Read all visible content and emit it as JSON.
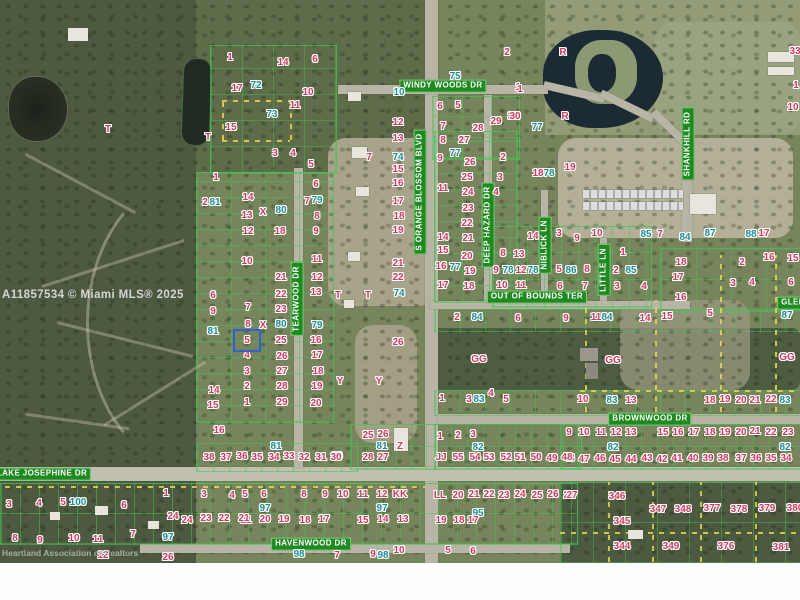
{
  "map": {
    "mls_watermark": "A11857534 © Miami MLS® 2025",
    "attribution_watermark": "Heartland Association of Realtors",
    "highlighted_lot": {
      "label": "5"
    },
    "colors": {
      "lot_number": "#cf3a5e",
      "block_number": "#1d8e93",
      "road_label_bg": "#1f8a1f",
      "road_label_text": "#ffffff",
      "highlight_border": "#2f63d4",
      "parcel_line": "#46c355",
      "boundary_dash": "#e6d84f"
    },
    "road_labels": [
      {
        "text": "WINDY WOODS DR",
        "x": 443,
        "y": 86,
        "v": false
      },
      {
        "text": "S ORANGE BLOSSOM BLVD",
        "x": 420,
        "y": 192,
        "v": true
      },
      {
        "text": "TEARWOOD DR",
        "x": 297,
        "y": 299,
        "v": true
      },
      {
        "text": "DEEP HAZARD DR",
        "x": 488,
        "y": 225,
        "v": true
      },
      {
        "text": "NIBLICK LN",
        "x": 545,
        "y": 245,
        "v": true
      },
      {
        "text": "LITTLE LN",
        "x": 604,
        "y": 270,
        "v": true
      },
      {
        "text": "OUT OF BOUNDS TER",
        "x": 537,
        "y": 297,
        "v": false
      },
      {
        "text": "SHANKHILL RD",
        "x": 688,
        "y": 144,
        "v": true
      },
      {
        "text": "GLEN",
        "x": 793,
        "y": 303,
        "v": false
      },
      {
        "text": "BROWNWOOD DR",
        "x": 650,
        "y": 419,
        "v": false
      },
      {
        "text": "LAKE JOSEPHINE DR",
        "x": 42,
        "y": 474,
        "v": false
      },
      {
        "text": "HAVENWOOD DR",
        "x": 311,
        "y": 544,
        "v": false
      }
    ],
    "lot_labels": [
      [
        "T",
        108,
        130
      ],
      [
        "1",
        230,
        58
      ],
      [
        "14",
        283,
        63
      ],
      [
        "6",
        315,
        60
      ],
      [
        "17",
        237,
        89
      ],
      [
        "72",
        256,
        86,
        "t"
      ],
      [
        "10",
        308,
        93
      ],
      [
        "11",
        295,
        106
      ],
      [
        "73",
        272,
        115,
        "t"
      ],
      [
        "15",
        231,
        128
      ],
      [
        "T",
        208,
        138
      ],
      [
        "3",
        275,
        154
      ],
      [
        "4",
        293,
        154
      ],
      [
        "5",
        311,
        165
      ],
      [
        "1",
        216,
        178
      ],
      [
        "2",
        205,
        203
      ],
      [
        "81",
        215,
        203,
        "t"
      ],
      [
        "14",
        248,
        198
      ],
      [
        "13",
        247,
        216
      ],
      [
        "X",
        263,
        213
      ],
      [
        "80",
        281,
        211,
        "t"
      ],
      [
        "12",
        248,
        232
      ],
      [
        "18",
        280,
        232
      ],
      [
        "10",
        247,
        262
      ],
      [
        "6",
        316,
        185
      ],
      [
        "7",
        307,
        202
      ],
      [
        "79",
        317,
        201,
        "t"
      ],
      [
        "8",
        317,
        217
      ],
      [
        "9",
        316,
        232
      ],
      [
        "11",
        317,
        260
      ],
      [
        "21",
        281,
        278
      ],
      [
        "12",
        317,
        278
      ],
      [
        "22",
        281,
        295
      ],
      [
        "13",
        316,
        293
      ],
      [
        "23",
        281,
        310
      ],
      [
        "7",
        248,
        308
      ],
      [
        "6",
        213,
        296
      ],
      [
        "9",
        213,
        312
      ],
      [
        "8",
        248,
        325
      ],
      [
        "X",
        263,
        326
      ],
      [
        "80",
        281,
        325,
        "t"
      ],
      [
        "79",
        317,
        326,
        "t"
      ],
      [
        "81",
        213,
        332,
        "t"
      ],
      [
        "25",
        281,
        341
      ],
      [
        "16",
        316,
        341
      ],
      [
        "4",
        247,
        356
      ],
      [
        "26",
        282,
        357
      ],
      [
        "17",
        317,
        356
      ],
      [
        "3",
        247,
        372
      ],
      [
        "27",
        282,
        372
      ],
      [
        "18",
        318,
        372
      ],
      [
        "2",
        247,
        387
      ],
      [
        "28",
        282,
        387
      ],
      [
        "19",
        317,
        387
      ],
      [
        "1",
        247,
        403
      ],
      [
        "29",
        282,
        403
      ],
      [
        "20",
        316,
        404
      ],
      [
        "14",
        214,
        391
      ],
      [
        "15",
        213,
        406
      ],
      [
        "16",
        219,
        431
      ],
      [
        "38",
        209,
        458
      ],
      [
        "37",
        226,
        458
      ],
      [
        "36",
        242,
        457
      ],
      [
        "35",
        257,
        458
      ],
      [
        "34",
        274,
        458
      ],
      [
        "33",
        289,
        457
      ],
      [
        "32",
        304,
        458
      ],
      [
        "31",
        321,
        458
      ],
      [
        "30",
        337,
        457
      ],
      [
        "81",
        276,
        447,
        "t"
      ],
      [
        "T",
        338,
        296
      ],
      [
        "T",
        368,
        296
      ],
      [
        "Y",
        340,
        382
      ],
      [
        "Y",
        379,
        382
      ],
      [
        "25",
        368,
        436
      ],
      [
        "26",
        383,
        435
      ],
      [
        "81",
        382,
        447,
        "t"
      ],
      [
        "Z",
        400,
        447
      ],
      [
        "28",
        368,
        458
      ],
      [
        "27",
        383,
        458
      ],
      [
        "7",
        369,
        158
      ],
      [
        "74",
        398,
        158,
        "t"
      ],
      [
        "75",
        455,
        77,
        "t"
      ],
      [
        "10",
        399,
        93,
        "t"
      ],
      [
        "1",
        518,
        88
      ],
      [
        "6",
        440,
        107
      ],
      [
        "5",
        458,
        106
      ],
      [
        "12",
        398,
        123
      ],
      [
        "7",
        443,
        127
      ],
      [
        "29",
        496,
        122
      ],
      [
        "30",
        513,
        117
      ],
      [
        "28",
        478,
        129
      ],
      [
        "13",
        398,
        139
      ],
      [
        "8",
        443,
        141
      ],
      [
        "27",
        464,
        141
      ],
      [
        "9",
        440,
        159
      ],
      [
        "77",
        455,
        154,
        "t"
      ],
      [
        "26",
        470,
        163
      ],
      [
        "2",
        503,
        158
      ],
      [
        "15",
        398,
        170
      ],
      [
        "25",
        467,
        178
      ],
      [
        "16",
        398,
        184
      ],
      [
        "24",
        468,
        193
      ],
      [
        "17",
        398,
        202
      ],
      [
        "23",
        468,
        209
      ],
      [
        "18",
        399,
        217
      ],
      [
        "22",
        467,
        224
      ],
      [
        "19",
        398,
        231
      ],
      [
        "21",
        468,
        239
      ],
      [
        "11",
        443,
        189
      ],
      [
        "14",
        443,
        238
      ],
      [
        "15",
        443,
        251
      ],
      [
        "16",
        441,
        267
      ],
      [
        "17",
        443,
        286
      ],
      [
        "20",
        467,
        257
      ],
      [
        "19",
        470,
        272
      ],
      [
        "18",
        469,
        287
      ],
      [
        "77",
        455,
        268,
        "t"
      ],
      [
        "21",
        398,
        264
      ],
      [
        "22",
        398,
        278
      ],
      [
        "74",
        399,
        294,
        "t"
      ],
      [
        "26",
        398,
        343
      ],
      [
        "3",
        500,
        178
      ],
      [
        "4",
        496,
        193
      ],
      [
        "14",
        533,
        237
      ],
      [
        "3",
        559,
        234
      ],
      [
        "9",
        577,
        239
      ],
      [
        "10",
        597,
        234
      ],
      [
        "85",
        646,
        235,
        "t"
      ],
      [
        "7",
        660,
        235
      ],
      [
        "8",
        503,
        254
      ],
      [
        "13",
        519,
        255
      ],
      [
        "9",
        496,
        271
      ],
      [
        "78",
        508,
        271,
        "t"
      ],
      [
        "12",
        521,
        271
      ],
      [
        "78",
        533,
        271,
        "t"
      ],
      [
        "5",
        559,
        270
      ],
      [
        "86",
        571,
        271,
        "t"
      ],
      [
        "8",
        587,
        270
      ],
      [
        "2",
        616,
        271
      ],
      [
        "85",
        631,
        271,
        "t"
      ],
      [
        "1",
        623,
        253
      ],
      [
        "10",
        502,
        286
      ],
      [
        "11",
        521,
        286
      ],
      [
        "6",
        560,
        287
      ],
      [
        "7",
        585,
        287
      ],
      [
        "3",
        617,
        287
      ],
      [
        "4",
        644,
        287
      ],
      [
        "R",
        563,
        53
      ],
      [
        "R",
        565,
        117
      ],
      [
        "2",
        507,
        53
      ],
      [
        "1",
        520,
        90
      ],
      [
        "30",
        515,
        117
      ],
      [
        "77",
        537,
        128,
        "t"
      ],
      [
        "19",
        570,
        168
      ],
      [
        "18",
        538,
        174
      ],
      [
        "78",
        549,
        174,
        "t"
      ],
      [
        "33",
        795,
        52
      ],
      [
        "1",
        796,
        86
      ],
      [
        "10",
        793,
        108
      ],
      [
        "84",
        685,
        238,
        "t"
      ],
      [
        "87",
        710,
        234,
        "t"
      ],
      [
        "88",
        751,
        235,
        "t"
      ],
      [
        "17",
        764,
        234
      ],
      [
        "16",
        769,
        258
      ],
      [
        "15",
        793,
        259
      ],
      [
        "18",
        681,
        263
      ],
      [
        "17",
        678,
        278
      ],
      [
        "16",
        681,
        298
      ],
      [
        "2",
        742,
        263
      ],
      [
        "3",
        733,
        284
      ],
      [
        "4",
        752,
        283
      ],
      [
        "6",
        791,
        283
      ],
      [
        "2",
        457,
        318
      ],
      [
        "84",
        477,
        318,
        "t"
      ],
      [
        "6",
        518,
        319
      ],
      [
        "9",
        566,
        319
      ],
      [
        "11",
        596,
        318
      ],
      [
        "84",
        607,
        318,
        "t"
      ],
      [
        "14",
        645,
        319
      ],
      [
        "15",
        667,
        317
      ],
      [
        "5",
        710,
        314
      ],
      [
        "87",
        787,
        316,
        "t"
      ],
      [
        "GG",
        479,
        360
      ],
      [
        "GG",
        613,
        361
      ],
      [
        "GG",
        787,
        358
      ],
      [
        "1",
        442,
        399
      ],
      [
        "3",
        469,
        400
      ],
      [
        "83",
        479,
        400,
        "t"
      ],
      [
        "4",
        491,
        394
      ],
      [
        "5",
        506,
        400
      ],
      [
        "10",
        583,
        400
      ],
      [
        "83",
        612,
        401,
        "t"
      ],
      [
        "13",
        631,
        401
      ],
      [
        "18",
        710,
        401
      ],
      [
        "19",
        725,
        400
      ],
      [
        "20",
        741,
        401
      ],
      [
        "21",
        755,
        401
      ],
      [
        "22",
        771,
        400
      ],
      [
        "83",
        785,
        401,
        "t"
      ],
      [
        "9",
        569,
        433
      ],
      [
        "10",
        584,
        433
      ],
      [
        "11",
        601,
        433
      ],
      [
        "12",
        616,
        433
      ],
      [
        "13",
        631,
        433
      ],
      [
        "15",
        663,
        433
      ],
      [
        "16",
        678,
        433
      ],
      [
        "17",
        694,
        433
      ],
      [
        "18",
        710,
        433
      ],
      [
        "19",
        725,
        433
      ],
      [
        "20",
        741,
        433
      ],
      [
        "21",
        755,
        432
      ],
      [
        "22",
        771,
        433
      ],
      [
        "23",
        788,
        433
      ],
      [
        "82",
        613,
        448,
        "t"
      ],
      [
        "82",
        785,
        448,
        "t"
      ],
      [
        "48",
        569,
        459
      ],
      [
        "47",
        584,
        460
      ],
      [
        "46",
        600,
        459
      ],
      [
        "45",
        615,
        460
      ],
      [
        "44",
        631,
        460
      ],
      [
        "43",
        647,
        459
      ],
      [
        "42",
        662,
        460
      ],
      [
        "41",
        677,
        459
      ],
      [
        "40",
        693,
        459
      ],
      [
        "39",
        708,
        459
      ],
      [
        "38",
        723,
        459
      ],
      [
        "37",
        741,
        459
      ],
      [
        "36",
        756,
        459
      ],
      [
        "35",
        771,
        459
      ],
      [
        "34",
        786,
        459
      ],
      [
        "1",
        440,
        437
      ],
      [
        "2",
        458,
        436
      ],
      [
        "3",
        473,
        435
      ],
      [
        "82",
        478,
        448,
        "t"
      ],
      [
        "JJ",
        441,
        458
      ],
      [
        "55",
        458,
        458
      ],
      [
        "54",
        475,
        458
      ],
      [
        "53",
        489,
        458
      ],
      [
        "52",
        506,
        458
      ],
      [
        "51",
        520,
        458
      ],
      [
        "50",
        536,
        458
      ],
      [
        "49",
        552,
        459
      ],
      [
        "48",
        567,
        458
      ],
      [
        "30",
        336,
        458
      ],
      [
        "4",
        232,
        496
      ],
      [
        "5",
        245,
        495
      ],
      [
        "6",
        264,
        495
      ],
      [
        "8",
        304,
        495
      ],
      [
        "9",
        325,
        495
      ],
      [
        "10",
        343,
        495
      ],
      [
        "11",
        363,
        495
      ],
      [
        "12",
        382,
        495
      ],
      [
        "KK",
        400,
        495
      ],
      [
        "LL",
        440,
        496
      ],
      [
        "20",
        458,
        496
      ],
      [
        "21",
        474,
        495
      ],
      [
        "22",
        489,
        495
      ],
      [
        "23",
        504,
        496
      ],
      [
        "24",
        520,
        495
      ],
      [
        "25",
        537,
        496
      ],
      [
        "26",
        553,
        495
      ],
      [
        "27",
        569,
        496
      ],
      [
        "97",
        265,
        509,
        "t"
      ],
      [
        "97",
        382,
        509,
        "t"
      ],
      [
        "95",
        478,
        514,
        "t"
      ],
      [
        "21",
        246,
        521
      ],
      [
        "20",
        265,
        520
      ],
      [
        "19",
        284,
        520
      ],
      [
        "18",
        305,
        521
      ],
      [
        "17",
        324,
        520
      ],
      [
        "15",
        363,
        521
      ],
      [
        "14",
        383,
        520
      ],
      [
        "13",
        403,
        520
      ],
      [
        "19",
        441,
        521
      ],
      [
        "18",
        459,
        521
      ],
      [
        "17",
        473,
        521
      ],
      [
        "24",
        173,
        517
      ],
      [
        "24",
        187,
        521
      ],
      [
        "23",
        206,
        519
      ],
      [
        "22",
        224,
        519
      ],
      [
        "21",
        244,
        519
      ],
      [
        "97",
        168,
        538,
        "t"
      ],
      [
        "26",
        168,
        558
      ],
      [
        "12",
        103,
        556
      ],
      [
        "98",
        299,
        555,
        "t"
      ],
      [
        "7",
        337,
        556
      ],
      [
        "9",
        373,
        555
      ],
      [
        "98",
        383,
        556,
        "t"
      ],
      [
        "10",
        399,
        551
      ],
      [
        "5",
        448,
        551
      ],
      [
        "6",
        473,
        552
      ],
      [
        "3",
        9,
        505
      ],
      [
        "4",
        39,
        504
      ],
      [
        "5",
        63,
        503
      ],
      [
        "100",
        78,
        503,
        "t"
      ],
      [
        "6",
        124,
        506
      ],
      [
        "8",
        15,
        539
      ],
      [
        "9",
        40,
        541
      ],
      [
        "10",
        74,
        539
      ],
      [
        "11",
        98,
        540
      ],
      [
        "7",
        133,
        535
      ],
      [
        "1",
        166,
        494
      ],
      [
        "3",
        204,
        495
      ],
      [
        "27",
        572,
        496
      ],
      [
        "346",
        617,
        497
      ],
      [
        "345",
        622,
        522
      ],
      [
        "344",
        622,
        547
      ],
      [
        "347",
        658,
        510
      ],
      [
        "348",
        683,
        510
      ],
      [
        "377",
        712,
        509
      ],
      [
        "378",
        739,
        510
      ],
      [
        "379",
        767,
        509
      ],
      [
        "380",
        795,
        509
      ],
      [
        "349",
        671,
        547
      ],
      [
        "376",
        726,
        547
      ],
      [
        "381",
        781,
        548
      ]
    ]
  }
}
